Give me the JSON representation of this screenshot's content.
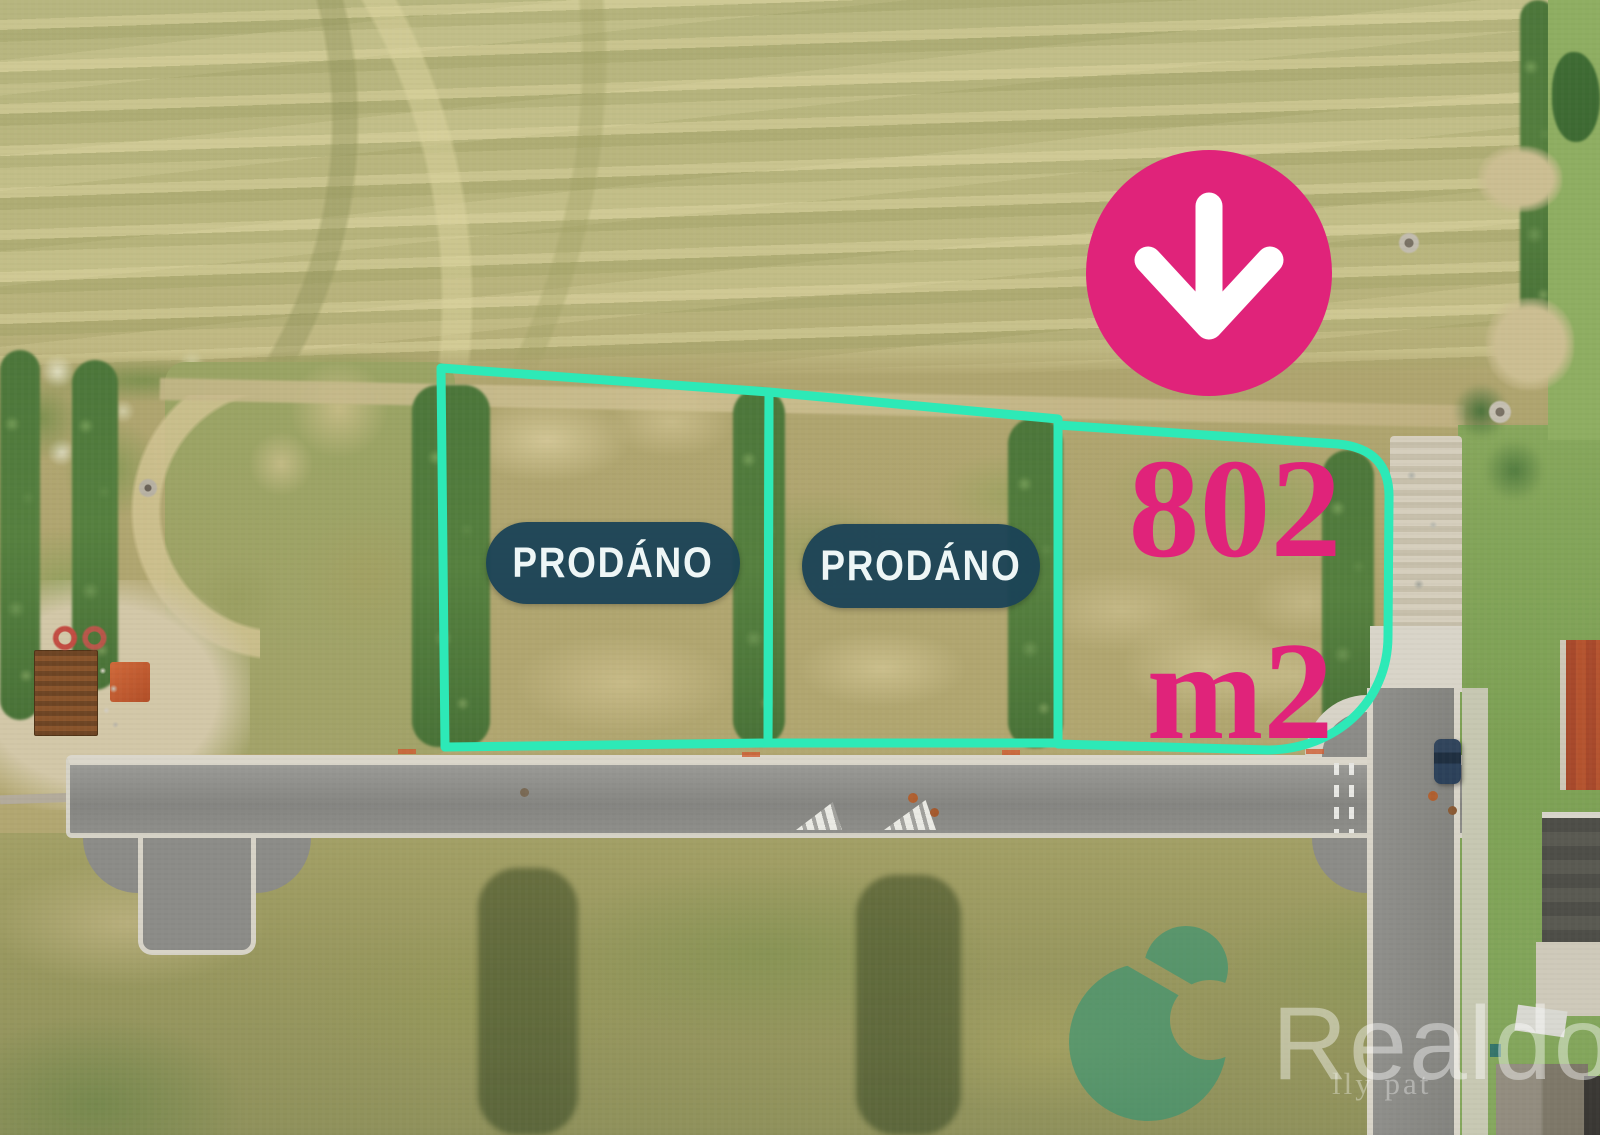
{
  "overlay": {
    "accent_color": "#2de9b7",
    "badge_color": "#1a4256",
    "pink_color": "#e0237a",
    "plots": [
      {
        "name": "plot-1",
        "status": "PRODÁNO"
      },
      {
        "name": "plot-2",
        "status": "PRODÁNO"
      },
      {
        "name": "plot-3",
        "area": "802",
        "unit": "m2"
      }
    ],
    "marker": {
      "icon": "arrow-down-icon",
      "color": "#e0237a"
    }
  },
  "watermark": {
    "brand": "Realdomus",
    "tagline": "lly pat",
    "logo_icon": "realdomus-leaf-logo",
    "logo_color": "#2f9474",
    "text_color": "#ffffff"
  }
}
